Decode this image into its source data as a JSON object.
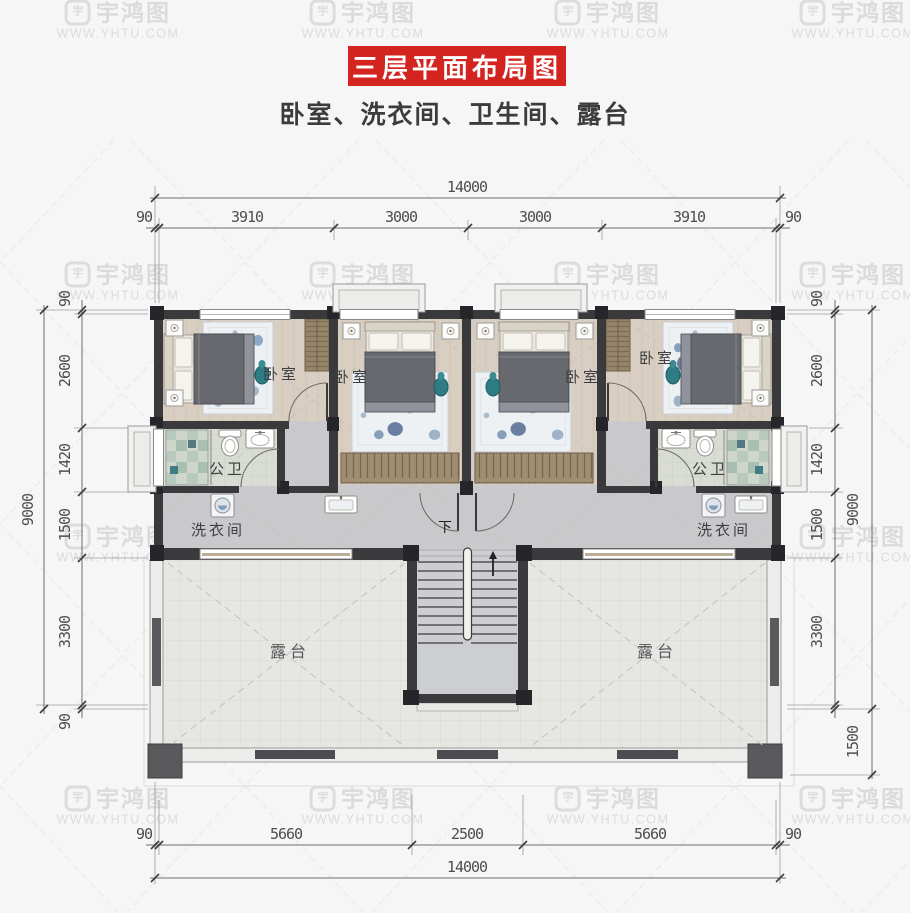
{
  "title": {
    "text": "三层平面布局图"
  },
  "subtitle": "卧室、洗衣间、卫生间、露台",
  "watermark": {
    "logo": "宇",
    "name": "宇鸿图",
    "url": "WWW.YHTU.COM"
  },
  "rooms": {
    "bedroom": "卧室",
    "bathroom": "公卫",
    "laundry": "洗衣间",
    "terrace": "露台",
    "stairs_down": "下"
  },
  "dimensions": {
    "top": {
      "total": "14000",
      "segments": [
        "90",
        "3910",
        "3000",
        "3000",
        "3910",
        "90"
      ]
    },
    "bottom": {
      "total": "14000",
      "segments": [
        "90",
        "5660",
        "2500",
        "5660",
        "90"
      ]
    },
    "left": {
      "total": "9000",
      "segments": [
        "90",
        "2600",
        "1420",
        "1500",
        "3300",
        "90"
      ]
    },
    "right": {
      "total": "9000",
      "segments": [
        "90",
        "2600",
        "1420",
        "1500",
        "3300"
      ],
      "extra": "1500"
    }
  },
  "colors": {
    "accent_red": "#d42420",
    "wall": "#3a3a3c",
    "marble_floor": "#c9c9cc",
    "wood_floor": "#d8cec1",
    "terrace_floor": "#e6e6e3",
    "bath_tile": "#d8dcd3",
    "watermark": "#dbdbdb"
  }
}
